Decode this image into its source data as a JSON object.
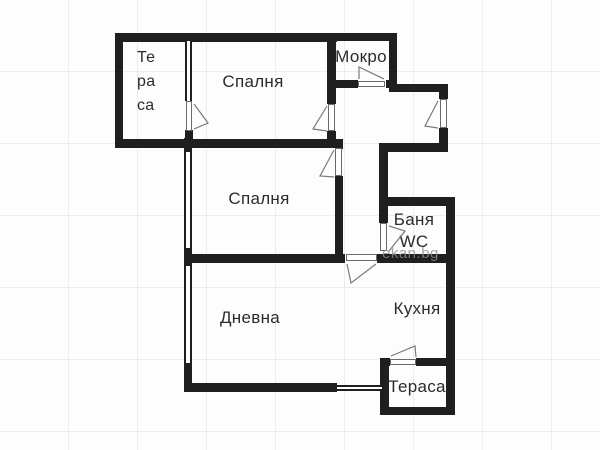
{
  "plan": {
    "rooms": [
      {
        "id": "terrace-top",
        "label": "Те\nра\nса"
      },
      {
        "id": "bedroom-1",
        "label": "Спалня"
      },
      {
        "id": "mokro",
        "label": "Мокро"
      },
      {
        "id": "bedroom-2",
        "label": "Спалня"
      },
      {
        "id": "bathroom-wc",
        "label": "Баня\nWC"
      },
      {
        "id": "living-room",
        "label": "Дневна"
      },
      {
        "id": "kitchen",
        "label": "Кухня"
      },
      {
        "id": "terrace-bottom",
        "label": "Тераса"
      }
    ],
    "watermark": "ekan.bg",
    "colors": {
      "wall": "#1f1f1f",
      "label_text": "#2b2b2b",
      "watermark": "#8f8f8f",
      "grid": "#ced3df",
      "background": "#fdfdfe"
    }
  }
}
